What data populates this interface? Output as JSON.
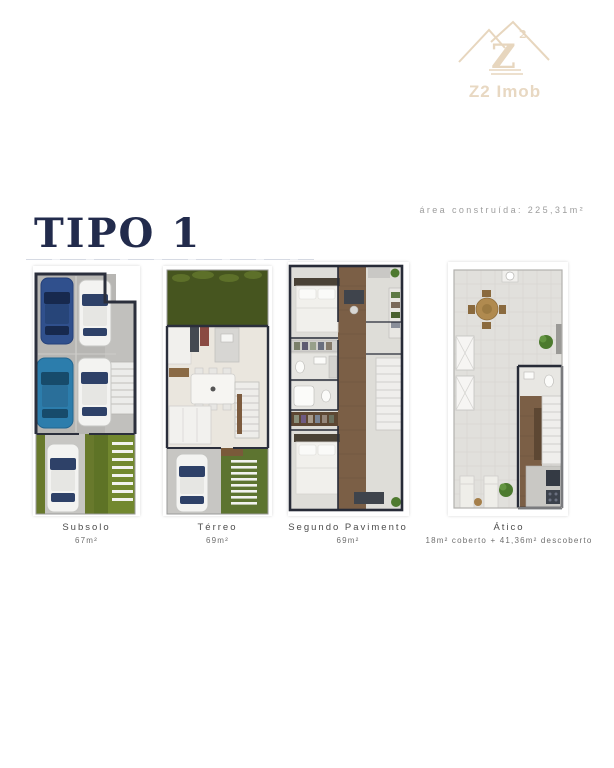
{
  "header": {
    "title": "TIPO 1",
    "built_area": "área construída: 225,31m²"
  },
  "logo": {
    "brand": "Z2 Imob",
    "monogram": "Z",
    "monogram_sup": "2"
  },
  "plans": [
    {
      "name": "Subsolo",
      "area": "67m²"
    },
    {
      "name": "Térreo",
      "area": "69m²"
    },
    {
      "name": "Segundo Pavimento",
      "area": "69m²"
    },
    {
      "name": "Ático",
      "area": "18m² coberto + 41,36m² descoberto"
    }
  ],
  "colors": {
    "accent_navy": "#222b4c",
    "logo_tan": "#e8d8c2",
    "label_gray": "#4c4c4c",
    "grass_green": "#5d7430",
    "garden_dark_green": "#46551f",
    "wood_brown": "#7b5f46",
    "car_navy": "#30508d",
    "car_teal": "#2c7dac",
    "garage_gray": "#b7b6b3"
  }
}
